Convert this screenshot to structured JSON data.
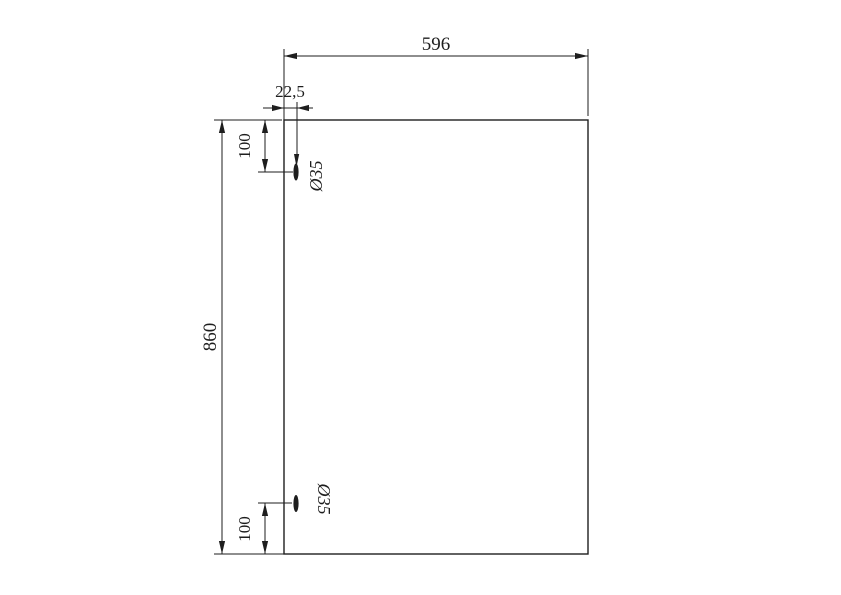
{
  "drawing": {
    "panel_width_label": "596",
    "panel_height_label": "860",
    "hole_offset_label": "22,5",
    "top_hole_distance_label": "100",
    "bottom_hole_distance_label": "100",
    "top_hole_diameter_label": "Ø35",
    "bottom_hole_diameter_label": "Ø35"
  },
  "colors": {
    "line": "#1e1e1e",
    "background": "#ffffff"
  }
}
